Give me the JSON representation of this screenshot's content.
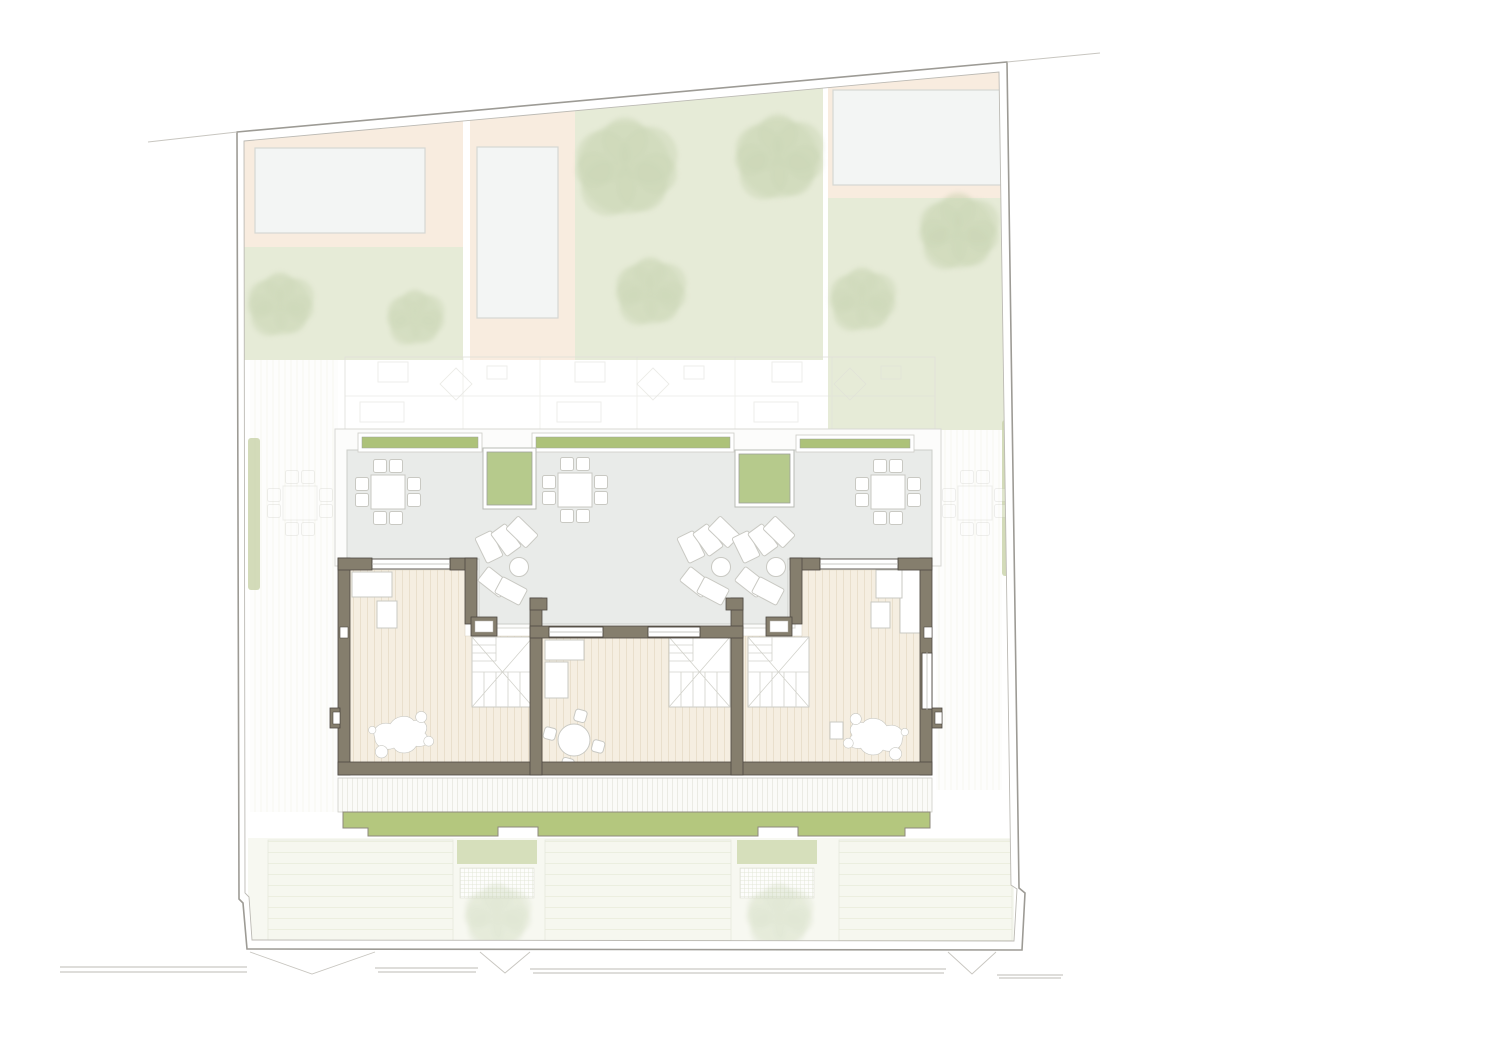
{
  "document": {
    "kind": "architectural roof plan drawing",
    "visible_text": "",
    "units_count": 3,
    "description": "Site plan of three attached townhouse units: roof level with terraces, planters, stairs and furniture; surrounding gardens with pools and trees; street edge with gates at bottom"
  },
  "colors": {
    "paper": "#ffffff",
    "boundary": "#9d9b95",
    "boundary_inner": "#bcbab4",
    "lawn": "#e6ebd7",
    "peach": "#f8ecdf",
    "pool": "#f3f5f4",
    "pool_border": "#d5d7d3",
    "tree": "#b8c89e",
    "terrace": "#e9ebe9",
    "terrace_border": "#cccec9",
    "planter": "#b6ca8c",
    "strip": "#adc279",
    "wall": "#857e6d",
    "wall_dark": "#4e4941",
    "wood": "#f5eee1",
    "wood_line": "#e6dcc7",
    "deck": "#fbfbf8",
    "deck_line": "#e7e7e0",
    "ghost": "#dfdfd9",
    "hedge": "#cbd5ad",
    "road": "#bdbbb4",
    "bottom_green": "#b4c77e",
    "ground_lawn": "#cdd8ae",
    "ground_stripe": "#e9ecdb",
    "furniture": "#c9c9c3"
  },
  "layers": {
    "pools": [
      {
        "x": 255,
        "y": 148,
        "w": 170,
        "h": 85
      },
      {
        "x": 477,
        "y": 147,
        "w": 81,
        "h": 171
      },
      {
        "x": 833,
        "y": 90,
        "w": 174,
        "h": 95
      }
    ],
    "trees_top": [
      {
        "x": 280,
        "y": 305,
        "r": 30,
        "o": 0.5
      },
      {
        "x": 415,
        "y": 318,
        "r": 26,
        "o": 0.48
      },
      {
        "x": 625,
        "y": 168,
        "r": 46,
        "o": 0.55
      },
      {
        "x": 650,
        "y": 292,
        "r": 32,
        "o": 0.5
      },
      {
        "x": 778,
        "y": 158,
        "r": 40,
        "o": 0.55
      },
      {
        "x": 862,
        "y": 300,
        "r": 30,
        "o": 0.5
      },
      {
        "x": 958,
        "y": 232,
        "r": 36,
        "o": 0.55
      }
    ],
    "trees_bottom": [
      {
        "x": 497,
        "y": 916,
        "r": 30,
        "o": 0.35
      },
      {
        "x": 779,
        "y": 916,
        "r": 30,
        "o": 0.35
      }
    ],
    "planters": [
      {
        "x": 483,
        "y": 448,
        "w": 53,
        "h": 61
      },
      {
        "x": 735,
        "y": 450,
        "w": 59,
        "h": 57
      }
    ],
    "strips": [
      {
        "x": 358,
        "y": 433,
        "w": 124,
        "h": 19
      },
      {
        "x": 532,
        "y": 433,
        "w": 202,
        "h": 19
      },
      {
        "x": 796,
        "y": 435,
        "w": 118,
        "h": 17
      }
    ],
    "hedges": [
      {
        "x": 248,
        "y": 438,
        "w": 12,
        "h": 152
      },
      {
        "x": 1002,
        "y": 420,
        "w": 13,
        "h": 156
      },
      {
        "x": 449,
        "y": 840,
        "w": 7,
        "h": 106
      },
      {
        "x": 729,
        "y": 840,
        "w": 7,
        "h": 106
      }
    ],
    "passages": [
      {
        "x": 250,
        "y": 360,
        "w": 88,
        "h": 452
      },
      {
        "x": 936,
        "y": 430,
        "w": 66,
        "h": 360
      }
    ],
    "dining_sets": [
      {
        "x": 388,
        "y": 492,
        "ghost": false
      },
      {
        "x": 575,
        "y": 490,
        "ghost": false
      },
      {
        "x": 888,
        "y": 492,
        "ghost": false
      },
      {
        "x": 300,
        "y": 503,
        "ghost": true
      },
      {
        "x": 975,
        "y": 503,
        "ghost": true
      }
    ],
    "lounger_groups": [
      {
        "x": 506,
        "y": 540
      },
      {
        "x": 708,
        "y": 540
      },
      {
        "x": 763,
        "y": 540
      }
    ],
    "stairs": [
      {
        "x": 472,
        "y": 637
      },
      {
        "x": 669,
        "y": 637
      },
      {
        "x": 748,
        "y": 637
      }
    ],
    "blobs": [
      {
        "x": 402,
        "y": 735,
        "flip": 1
      },
      {
        "x": 875,
        "y": 737,
        "flip": -1
      }
    ],
    "round_tables": [
      {
        "x": 574,
        "y": 740
      }
    ],
    "furniture": [
      [
        352,
        572,
        40,
        25
      ],
      [
        377,
        601,
        20,
        27
      ],
      [
        545,
        640,
        39,
        20
      ],
      [
        545,
        662,
        23,
        36
      ],
      [
        900,
        570,
        20,
        63
      ],
      [
        876,
        570,
        26,
        28
      ],
      [
        871,
        602,
        19,
        26
      ],
      [
        830,
        722,
        13,
        17
      ]
    ],
    "windows_glazed": [
      [
        372,
        558,
        78,
        12
      ],
      [
        820,
        558,
        78,
        12
      ],
      [
        549,
        626,
        54,
        12
      ],
      [
        648,
        626,
        52,
        12
      ],
      [
        922,
        652,
        10,
        58
      ]
    ],
    "windows_sill": [
      [
        471,
        617,
        26,
        19
      ],
      [
        766,
        617,
        26,
        19
      ]
    ],
    "wall_notches": [
      [
        340,
        627,
        8,
        11
      ],
      [
        924,
        627,
        8,
        11
      ],
      [
        333,
        712,
        7,
        12
      ],
      [
        935,
        712,
        7,
        12
      ]
    ],
    "ground_blocks": [
      [
        268,
        840,
        185,
        107
      ],
      [
        545,
        840,
        186,
        107
      ],
      [
        839,
        840,
        173,
        106
      ]
    ],
    "green_patches": [
      [
        457,
        840,
        80,
        24
      ],
      [
        737,
        840,
        80,
        24
      ]
    ],
    "hatch_patches": [
      [
        460,
        868,
        74,
        30
      ],
      [
        740,
        868,
        74,
        30
      ]
    ],
    "road_segments": [
      [
        60,
        967,
        247,
        967
      ],
      [
        60,
        972,
        247,
        972
      ],
      [
        375,
        968,
        478,
        968
      ],
      [
        378,
        972,
        476,
        972
      ],
      [
        530,
        969,
        946,
        969
      ],
      [
        533,
        973,
        944,
        973
      ],
      [
        997,
        975,
        1063,
        975
      ],
      [
        999,
        978,
        1061,
        978
      ]
    ],
    "gates": [
      [
        250,
        952,
        312,
        974,
        375,
        952
      ],
      [
        480,
        952,
        505,
        973,
        530,
        952
      ],
      [
        948,
        952,
        972,
        974,
        996,
        952
      ]
    ],
    "boundary_stubs": [
      [
        148,
        142,
        237,
        132
      ],
      [
        1007,
        62,
        1100,
        53
      ]
    ]
  }
}
